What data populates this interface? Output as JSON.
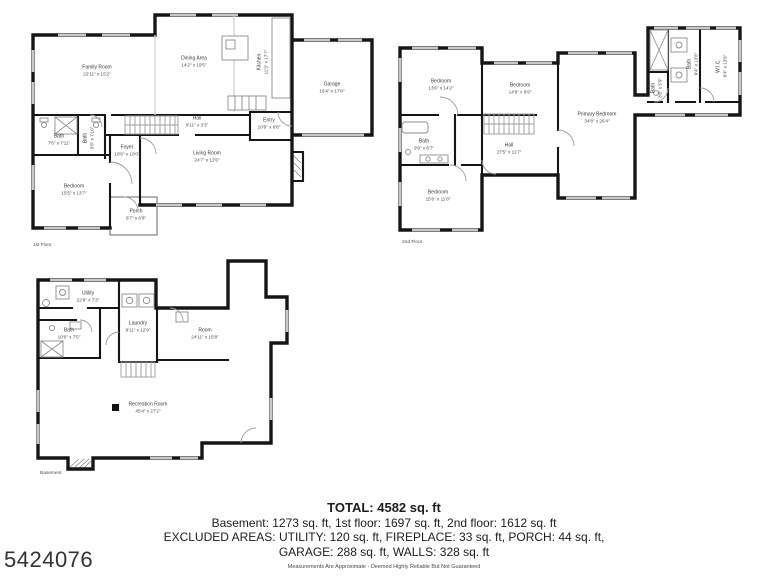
{
  "floors": {
    "first": {
      "caption": "1st Floor",
      "rooms": {
        "family_room": {
          "name": "Family Room",
          "dims": "22'11\" x 15'2\""
        },
        "dining_area": {
          "name": "Dining Area",
          "dims": "14'2\" x 19'5\""
        },
        "kitchen": {
          "name": "Kitchen",
          "dims": "11'3\" x 17'7\""
        },
        "garage": {
          "name": "Garage",
          "dims": "16'4\" x 17'8\""
        },
        "hall": {
          "name": "Hall",
          "dims": "9'11\" x 3'3\""
        },
        "entry": {
          "name": "Entry",
          "dims": "10'6\" x 6'8\""
        },
        "bath": {
          "name": "Bath",
          "dims": "7'6\" x 7'11\""
        },
        "bath2": {
          "name": "Bath",
          "dims": "3'8\" x 7'10\""
        },
        "foyer": {
          "name": "Foyer",
          "dims": "10'6\" x 10'0\""
        },
        "living_room": {
          "name": "Living Room",
          "dims": "24'7\" x 12'6\""
        },
        "bedroom": {
          "name": "Bedroom",
          "dims": "15'5\" x 13'7\""
        },
        "porch": {
          "name": "Porch",
          "dims": "6'7\" x 6'8\""
        }
      }
    },
    "second": {
      "caption": "2nd Floor",
      "rooms": {
        "bedroom1": {
          "name": "Bedroom",
          "dims": "13'6\" x 14'2\""
        },
        "bedroom2": {
          "name": "Bedroom",
          "dims": "14'9\" x 9'9\""
        },
        "primary_bedroom": {
          "name": "Primary Bedroom",
          "dims": "34'8\" x 26'4\""
        },
        "bath1": {
          "name": "Bath",
          "dims": "9'9\" x 6'7\""
        },
        "hall": {
          "name": "Hall",
          "dims": "27'5\" x 11'7\""
        },
        "bedroom3": {
          "name": "Bedroom",
          "dims": "15'6\" x 11'8\""
        },
        "bath2": {
          "name": "Bath",
          "dims": "3'8\" x 5'9\""
        },
        "bath3": {
          "name": "Bath",
          "dims": "9'4\" x 13'8\""
        },
        "wic": {
          "name": "W.I.C.",
          "dims": "8'4\" x 13'8\""
        }
      }
    },
    "basement": {
      "caption": "Basement",
      "rooms": {
        "utility": {
          "name": "Utility",
          "dims": "22'8\" x 7'3\""
        },
        "bath": {
          "name": "Bath",
          "dims": "10'6\" x 7'5\""
        },
        "laundry": {
          "name": "Laundry",
          "dims": "9'11\" x 12'9\""
        },
        "room": {
          "name": "Room",
          "dims": "24'11\" x 15'8\""
        },
        "recreation_room": {
          "name": "Recreation Room",
          "dims": "45'4\" x 27'2\""
        }
      }
    }
  },
  "summary": {
    "total": "TOTAL: 4582 sq. ft",
    "floors_line": "Basement: 1273 sq. ft, 1st floor: 1697 sq. ft, 2nd floor: 1612 sq. ft",
    "excluded_line1": "EXCLUDED AREAS: UTILITY: 120 sq. ft, FIREPLACE: 33 sq. ft, PORCH: 44 sq. ft,",
    "excluded_line2": "GARAGE: 288 sq. ft, WALLS: 328 sq. ft",
    "disclaimer": "Measurements Are Approximate - Deemed Highly Reliable But Not Guaranteed"
  },
  "mls_number": "5424076"
}
